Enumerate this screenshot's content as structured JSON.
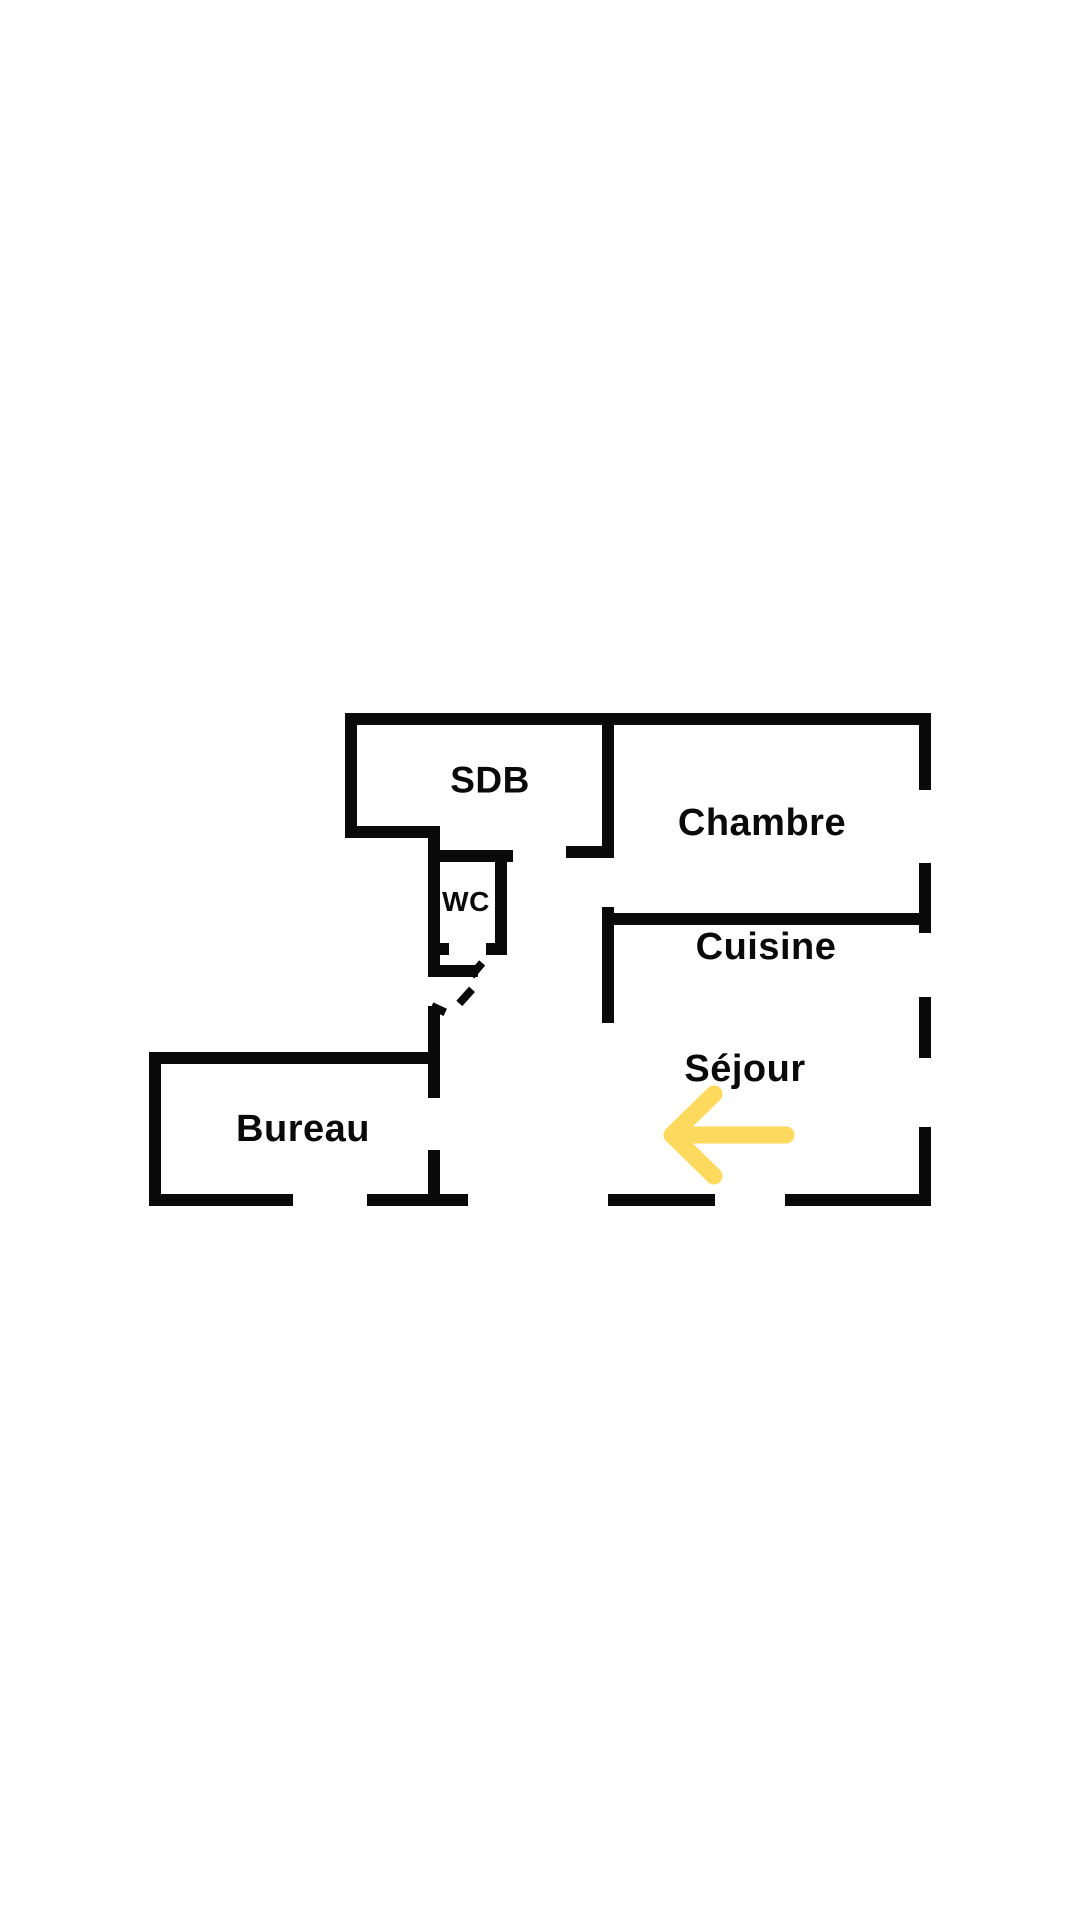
{
  "canvas": {
    "background_color": "#ffffff"
  },
  "floor_plan": {
    "wall_color": "#0a0a0a",
    "rooms": [
      {
        "id": "sdb",
        "label": "SDB"
      },
      {
        "id": "chambre",
        "label": "Chambre"
      },
      {
        "id": "wc",
        "label": "WC"
      },
      {
        "id": "cuisine",
        "label": "Cuisine"
      },
      {
        "id": "sejour",
        "label": "Séjour"
      },
      {
        "id": "bureau",
        "label": "Bureau"
      }
    ],
    "entrance_arrow": {
      "direction": "left",
      "color": "#FDD95E"
    }
  }
}
